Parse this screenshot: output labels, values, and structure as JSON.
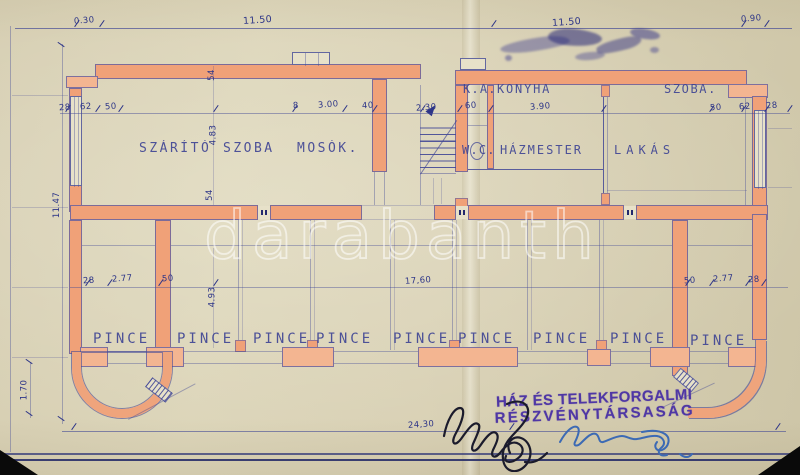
{
  "watermark": "darabanth",
  "stamp": {
    "line1": "HÁZ ÉS TELEKFORGALMI",
    "line2": "RÉSZVÉNYTÁRSASÁG"
  },
  "rooms": {
    "upper": [
      "SZÁRÍTÓ",
      "SZOBA",
      "MOSÓK.",
      "K.A.",
      "KONYHA",
      "SZOBA.",
      "W.C.",
      "HÁZMESTER",
      "LAKÁS"
    ],
    "basement": [
      "PINCE",
      "PINCE",
      "PINCE",
      "PINCE",
      "PINCE",
      "PINCE",
      "PINCE",
      "PINCE",
      "PINCE"
    ]
  },
  "dims": {
    "top_030": "0.30",
    "top_1150_left": "11.50",
    "top_1150_right": "11.50",
    "top_090": "0.90",
    "left_1147": "11.47",
    "left_28": "28",
    "left_62": "62",
    "left_50": "50",
    "v_54_top": "54",
    "v_483": "4.83",
    "v_54_bottom": "54",
    "mosok_8": "8",
    "mosok_300": "3.00",
    "mosok_40": "40",
    "stair_230": "2.30",
    "door_60": "60",
    "konyha_390": "3.90",
    "right_50": "50",
    "right_62": "62",
    "right_28": "28",
    "cellar_left_28": "28",
    "cellar_left_277": "2.77",
    "cellar_left_50": "50",
    "cellar_v_493": "4.93",
    "cellar_1760": "17,60",
    "cellar_right_50": "50",
    "cellar_right_277": "2.77",
    "cellar_right_28": "28",
    "left_170": "1.70",
    "bottom_2430": "24,30"
  },
  "colors": {
    "paper": "#d8d1b5",
    "ink": "#474d9b",
    "wall_fill": "#f0a178",
    "wall_edge": "#df7149",
    "stamp": "#4f37a5",
    "watermark": "#ffffff",
    "signature_black": "#1b1b2c",
    "signature_blue": "#3c6ab4"
  }
}
